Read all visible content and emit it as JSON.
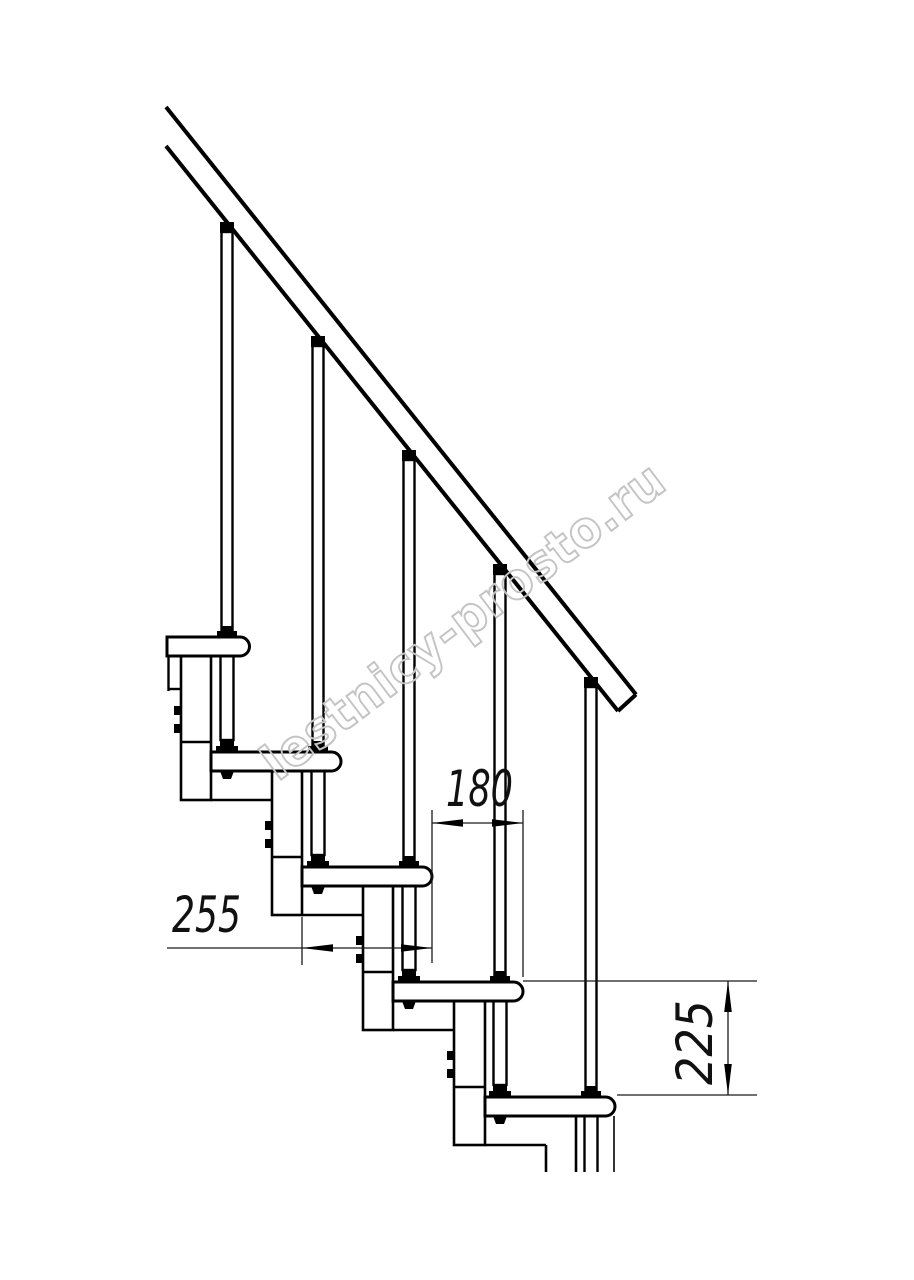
{
  "page": {
    "background": "#ffffff",
    "line_color": "#000000",
    "watermark_color": "#c4c4c4"
  },
  "drawing": {
    "type": "staircase-side-elevation",
    "dimensions": {
      "step_run": "180",
      "tread_depth": "255",
      "step_rise": "225"
    },
    "watermark": "lestnicy-prosto.ru"
  }
}
